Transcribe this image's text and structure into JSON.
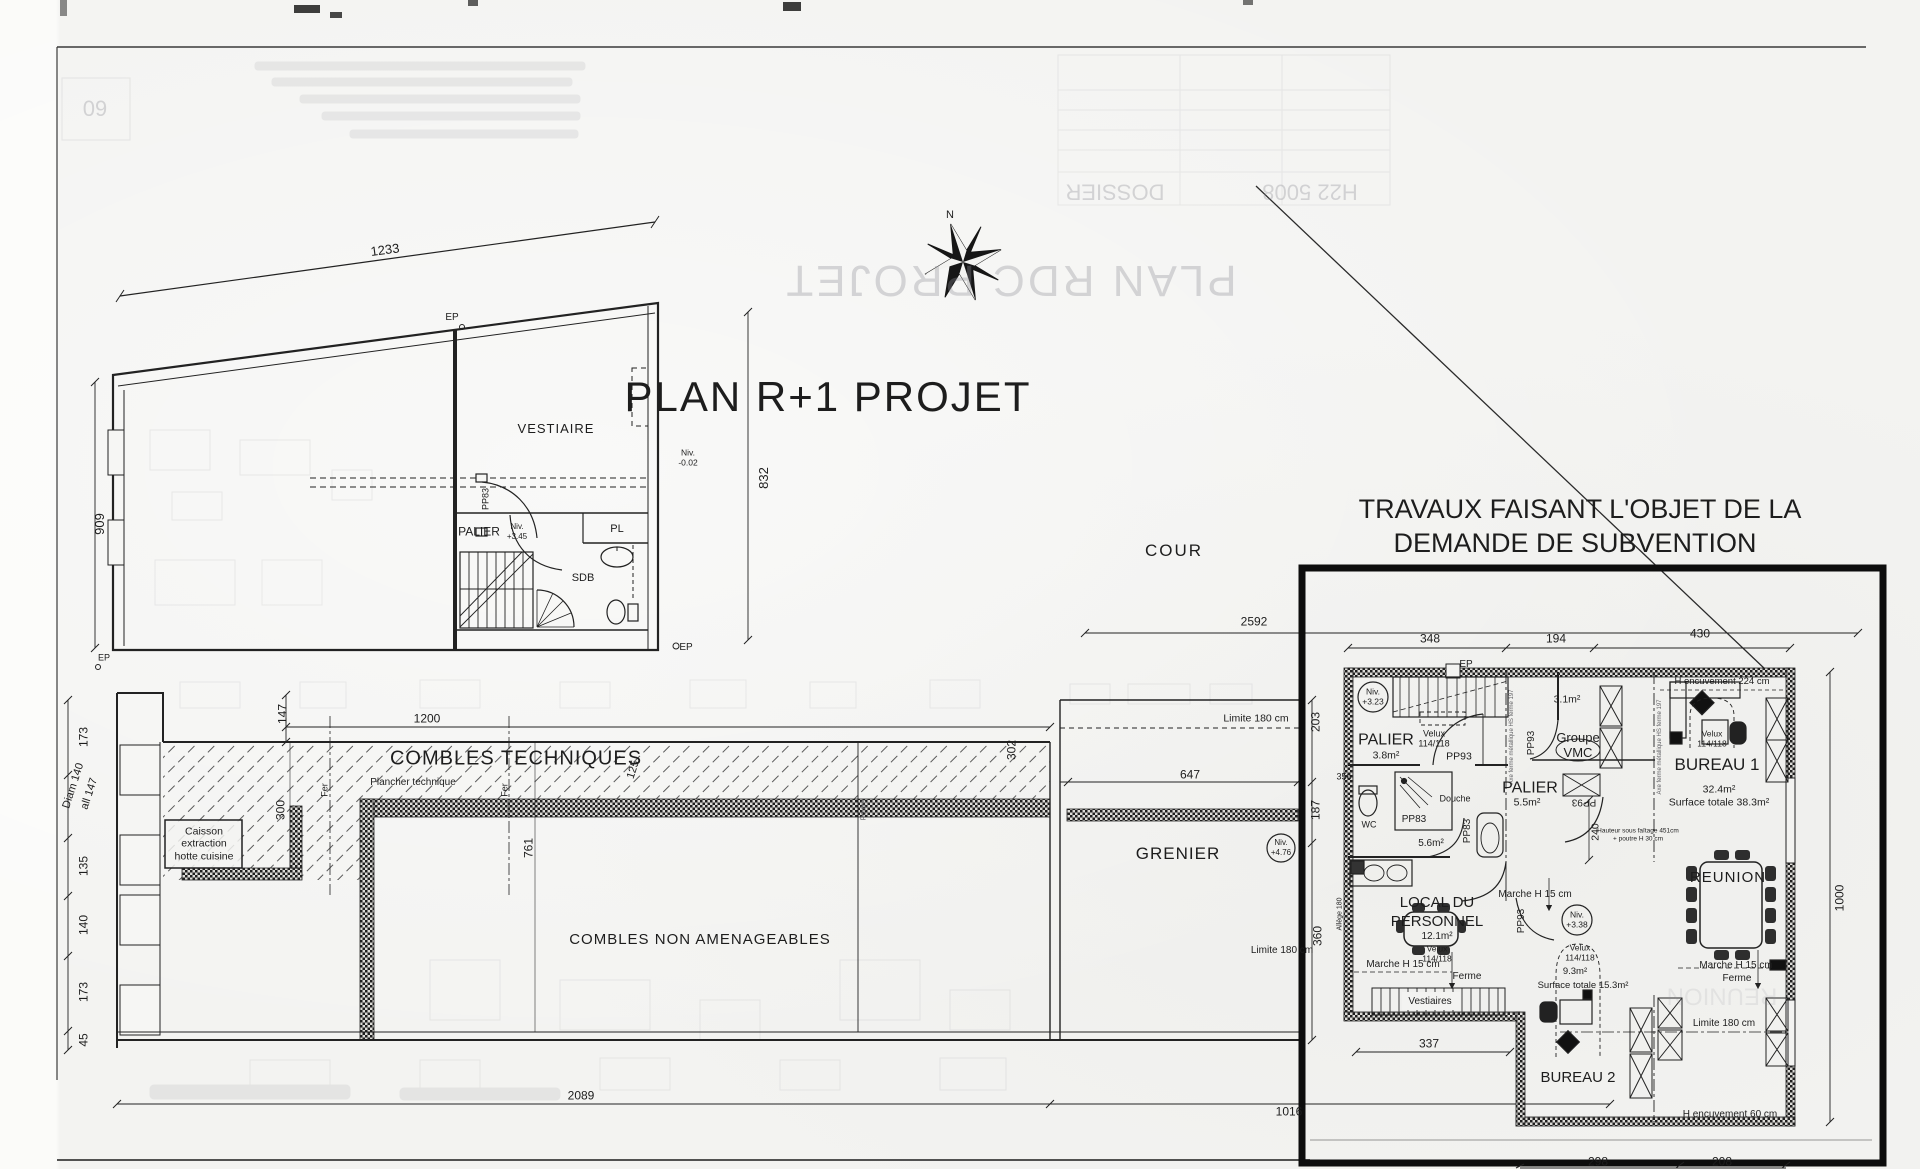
{
  "colors": {
    "ink": "#1d1d1d",
    "paper": "#f3f3f1",
    "bold_zone": "#0d0d0d",
    "bleed": "#8d8d95"
  },
  "sheet": {
    "main_title": "PLAN R+1 PROJET",
    "subvention_note_line1": "TRAVAUX FAISANT L'OBJET DE LA",
    "subvention_note_line2": "DEMANDE DE SUBVENTION",
    "courtyard_label": "COUR",
    "compass_north": "N",
    "bleedthrough": {
      "mirrored_title": "PLAN RDC PROJET",
      "sheet_number": "60",
      "titleblock_left": "DOSSIER",
      "titleblock_right": "H22 5008",
      "mirrored_room": "REUNION"
    }
  },
  "labels": [
    {
      "n": "dim-1233",
      "t": "1233",
      "x": 385,
      "y": 250,
      "s": 13,
      "r": -7.5
    },
    {
      "n": "ep-roof-label",
      "t": "EP",
      "x": 452,
      "y": 318,
      "s": 10
    },
    {
      "n": "dim-909",
      "t": "909",
      "x": 100,
      "y": 524,
      "s": 13,
      "r": -90
    },
    {
      "n": "room-vestiaire",
      "t": "VESTIAIRE",
      "x": 556,
      "y": 429,
      "s": 13,
      "ls": 1
    },
    {
      "n": "niv-minus002-l1",
      "t": "Niv.",
      "x": 688,
      "y": 453,
      "s": 8.5
    },
    {
      "n": "niv-minus002-l2",
      "t": "-0.02",
      "x": 688,
      "y": 463,
      "s": 8.5
    },
    {
      "n": "door-pp83-upper",
      "t": "PP83",
      "x": 486,
      "y": 499,
      "s": 9,
      "r": -90
    },
    {
      "n": "room-palier-upper",
      "t": "PALIER",
      "x": 479,
      "y": 532,
      "s": 12
    },
    {
      "n": "niv-345-l1",
      "t": "Niv.",
      "x": 517,
      "y": 527,
      "s": 8
    },
    {
      "n": "niv-345-l2",
      "t": "+3.45",
      "x": 517,
      "y": 537,
      "s": 8
    },
    {
      "n": "room-pl",
      "t": "PL",
      "x": 617,
      "y": 530,
      "s": 11
    },
    {
      "n": "room-sdb",
      "t": "SDB",
      "x": 583,
      "y": 579,
      "s": 11
    },
    {
      "n": "ep-bottom-label",
      "t": "EP",
      "x": 686,
      "y": 648,
      "s": 10
    },
    {
      "n": "dim-832",
      "t": "832",
      "x": 764,
      "y": 478,
      "s": 13,
      "r": -90
    },
    {
      "n": "ep-attic-label",
      "t": "EP",
      "x": 104,
      "y": 658,
      "s": 9
    },
    {
      "n": "dim-173a",
      "t": "173",
      "x": 84,
      "y": 737,
      "s": 12,
      "r": -90
    },
    {
      "n": "dim-diam140",
      "t": "Diam 140",
      "x": 74,
      "y": 786,
      "s": 11,
      "r": -72
    },
    {
      "n": "dim-all147",
      "t": "all 147",
      "x": 90,
      "y": 794,
      "s": 11,
      "r": -72
    },
    {
      "n": "dim-135",
      "t": "135",
      "x": 84,
      "y": 866,
      "s": 12,
      "r": -90
    },
    {
      "n": "dim-140",
      "t": "140",
      "x": 84,
      "y": 925,
      "s": 12,
      "r": -90
    },
    {
      "n": "dim-173b",
      "t": "173",
      "x": 84,
      "y": 992,
      "s": 12,
      "r": -90
    },
    {
      "n": "dim-45",
      "t": "45",
      "x": 84,
      "y": 1040,
      "s": 12,
      "r": -90
    },
    {
      "n": "dim-147",
      "t": "147",
      "x": 283,
      "y": 714,
      "s": 12,
      "r": -90
    },
    {
      "n": "dim-1200",
      "t": "1200",
      "x": 427,
      "y": 719,
      "s": 12
    },
    {
      "n": "room-combles-techniques",
      "t": "COMBLES TECHNIQUES",
      "x": 516,
      "y": 759,
      "s": 20,
      "ls": 1
    },
    {
      "n": "note-plancher-technique",
      "t": "Plancher technique",
      "x": 413,
      "y": 783,
      "s": 10
    },
    {
      "n": "axis-fer-1",
      "t": "Fer",
      "x": 325,
      "y": 790,
      "s": 9,
      "r": -90
    },
    {
      "n": "axis-fer-2",
      "t": "Fer",
      "x": 505,
      "y": 790,
      "s": 9,
      "r": -90
    },
    {
      "n": "dim-300",
      "t": "300",
      "x": 281,
      "y": 810,
      "s": 12,
      "r": -90
    },
    {
      "n": "dim-125",
      "t": "125",
      "x": 634,
      "y": 770,
      "s": 11,
      "r": -72
    },
    {
      "n": "dim-761",
      "t": "761",
      "x": 529,
      "y": 848,
      "s": 12,
      "r": -90
    },
    {
      "n": "caisson-l1",
      "t": "Caisson",
      "x": 204,
      "y": 832,
      "s": 10.5
    },
    {
      "n": "caisson-l2",
      "t": "extraction",
      "x": 204,
      "y": 844,
      "s": 10.5
    },
    {
      "n": "caisson-l3",
      "t": "hotte cuisine",
      "x": 204,
      "y": 857,
      "s": 10.5
    },
    {
      "n": "room-combles-non-amenageables",
      "t": "COMBLES NON AMENAGEABLES",
      "x": 700,
      "y": 940,
      "s": 15,
      "ls": 1
    },
    {
      "n": "dim-302",
      "t": "302",
      "x": 1012,
      "y": 750,
      "s": 12,
      "r": -90
    },
    {
      "n": "axis-poutre",
      "t": "Poutre",
      "x": 864,
      "y": 810,
      "s": 7,
      "r": -90,
      "c": "gray"
    },
    {
      "n": "room-grenier",
      "t": "GRENIER",
      "x": 1178,
      "y": 854,
      "s": 17,
      "ls": 1
    },
    {
      "n": "niv-476-l1",
      "t": "Niv.",
      "x": 1281,
      "y": 843,
      "s": 8
    },
    {
      "n": "niv-476-l2",
      "t": "+4.76",
      "x": 1281,
      "y": 853,
      "s": 8
    },
    {
      "n": "dim-647",
      "t": "647",
      "x": 1190,
      "y": 775,
      "s": 12
    },
    {
      "n": "limite-180-grenier-haut",
      "t": "Limite 180 cm",
      "x": 1256,
      "y": 719,
      "s": 10.5
    },
    {
      "n": "dim-203",
      "t": "203",
      "x": 1316,
      "y": 722,
      "s": 12,
      "r": -90
    },
    {
      "n": "dim-187",
      "t": "187",
      "x": 1316,
      "y": 810,
      "s": 12,
      "r": -90
    },
    {
      "n": "dim-356",
      "t": "356",
      "x": 1344,
      "y": 777,
      "s": 9
    },
    {
      "n": "dim-360",
      "t": "360",
      "x": 1318,
      "y": 936,
      "s": 12,
      "r": -90
    },
    {
      "n": "limite-180-grenier-bas",
      "t": "Limite 180 cm",
      "x": 1282,
      "y": 951,
      "s": 10
    },
    {
      "n": "dim-allege-180",
      "t": "Allège 180",
      "x": 1340,
      "y": 914,
      "s": 7,
      "r": -90
    },
    {
      "n": "dim-2592",
      "t": "2592",
      "x": 1254,
      "y": 622,
      "s": 12
    },
    {
      "n": "dim-2089",
      "t": "2089",
      "x": 581,
      "y": 1096,
      "s": 12
    },
    {
      "n": "dim-1016",
      "t": "1016",
      "x": 1289,
      "y": 1112,
      "s": 12
    },
    {
      "n": "dim-348",
      "t": "348",
      "x": 1430,
      "y": 639,
      "s": 12
    },
    {
      "n": "dim-194",
      "t": "194",
      "x": 1556,
      "y": 639,
      "s": 12
    },
    {
      "n": "dim-430",
      "t": "430",
      "x": 1700,
      "y": 634,
      "s": 12
    },
    {
      "n": "ep-zone-label",
      "t": "EP",
      "x": 1466,
      "y": 665,
      "s": 10
    },
    {
      "n": "niv-323-l1",
      "t": "Niv.",
      "x": 1373,
      "y": 692,
      "s": 8.5
    },
    {
      "n": "niv-323-l2",
      "t": "+3.23",
      "x": 1373,
      "y": 702,
      "s": 8.5
    },
    {
      "n": "room-palier-1",
      "t": "PALIER",
      "x": 1386,
      "y": 741,
      "s": 16
    },
    {
      "n": "palier-1-surface",
      "t": "3.8m²",
      "x": 1386,
      "y": 756,
      "s": 10.5
    },
    {
      "n": "velux-palier-l1",
      "t": "Velux",
      "x": 1434,
      "y": 734,
      "s": 9
    },
    {
      "n": "velux-palier-l2",
      "t": "114/118",
      "x": 1434,
      "y": 744,
      "s": 9
    },
    {
      "n": "door-pp93-palier",
      "t": "PP93",
      "x": 1459,
      "y": 757,
      "s": 10.5
    },
    {
      "n": "vmc-surface",
      "t": "3.1m²",
      "x": 1567,
      "y": 700,
      "s": 10.5
    },
    {
      "n": "groupe-vmc-l1",
      "t": "Groupe",
      "x": 1578,
      "y": 738,
      "s": 13
    },
    {
      "n": "groupe-vmc-l2",
      "t": "VMC",
      "x": 1578,
      "y": 753,
      "s": 13
    },
    {
      "n": "door-pp93-vmc",
      "t": "PP93",
      "x": 1532,
      "y": 743,
      "s": 10,
      "r": -90
    },
    {
      "n": "axis-ferme-1",
      "t": "Axe ferme métallique HS ferme 197",
      "x": 1512,
      "y": 737,
      "s": 6,
      "r": -90,
      "c": "gray"
    },
    {
      "n": "axis-ferme-2",
      "t": "Axe ferme métallique HS ferme 197",
      "x": 1660,
      "y": 747,
      "s": 6,
      "r": -90,
      "c": "gray"
    },
    {
      "n": "room-palier-2",
      "t": "PALIER",
      "x": 1530,
      "y": 789,
      "s": 16
    },
    {
      "n": "palier-2-surface",
      "t": "5.5m²",
      "x": 1527,
      "y": 803,
      "s": 10.5
    },
    {
      "n": "door-pp93-flip",
      "t": "PP93",
      "x": 1584,
      "y": 801,
      "s": 10,
      "r": 180
    },
    {
      "n": "dim-240",
      "t": "240",
      "x": 1596,
      "y": 832,
      "s": 10.5,
      "r": -90
    },
    {
      "n": "note-faitage-l1",
      "t": "Hauteur sous faîtage 451cm",
      "x": 1638,
      "y": 832,
      "s": 6.5
    },
    {
      "n": "note-faitage-l2",
      "t": "+ poutre H 30 cm",
      "x": 1638,
      "y": 840,
      "s": 6.5
    },
    {
      "n": "fixture-douche",
      "t": "Douche",
      "x": 1455,
      "y": 799,
      "s": 9
    },
    {
      "n": "fixture-wc",
      "t": "WC",
      "x": 1369,
      "y": 825,
      "s": 9
    },
    {
      "n": "door-pp83-a",
      "t": "PP83",
      "x": 1414,
      "y": 820,
      "s": 10
    },
    {
      "n": "door-pp83-b",
      "t": "PP83",
      "x": 1468,
      "y": 831,
      "s": 10,
      "r": -90
    },
    {
      "n": "sdb-surface",
      "t": "5.6m²",
      "x": 1431,
      "y": 844,
      "s": 10
    },
    {
      "n": "note-encuvement-224",
      "t": "H encuvement 224 cm",
      "x": 1722,
      "y": 682,
      "s": 9.5
    },
    {
      "n": "velux-b1-l1",
      "t": "Velux",
      "x": 1712,
      "y": 734,
      "s": 8.5
    },
    {
      "n": "velux-b1-l2",
      "t": "114/118",
      "x": 1712,
      "y": 744,
      "s": 8.5
    },
    {
      "n": "room-bureau-1",
      "t": "BUREAU 1",
      "x": 1717,
      "y": 765,
      "s": 17
    },
    {
      "n": "bureau-1-surface",
      "t": "32.4m²",
      "x": 1719,
      "y": 790,
      "s": 10.5
    },
    {
      "n": "bureau-1-surface-totale",
      "t": "Surface totale 38.3m²",
      "x": 1719,
      "y": 803,
      "s": 10.5
    },
    {
      "n": "room-reunion",
      "t": "REUNION",
      "x": 1728,
      "y": 878,
      "s": 15,
      "ls": 1
    },
    {
      "n": "dim-1000",
      "t": "1000",
      "x": 1840,
      "y": 898,
      "s": 12,
      "r": -90
    },
    {
      "n": "room-local-l1",
      "t": "LOCAL DU",
      "x": 1437,
      "y": 903,
      "s": 15
    },
    {
      "n": "room-local-l2",
      "t": "PERSONNEL",
      "x": 1437,
      "y": 922,
      "s": 15
    },
    {
      "n": "local-surface",
      "t": "12.1m²",
      "x": 1437,
      "y": 937,
      "s": 10
    },
    {
      "n": "velux-local-l1",
      "t": "Velux",
      "x": 1437,
      "y": 949,
      "s": 8.5
    },
    {
      "n": "velux-local-l2",
      "t": "114/118",
      "x": 1437,
      "y": 959,
      "s": 8.5
    },
    {
      "n": "marche-local",
      "t": "Marche H 15 cm",
      "x": 1403,
      "y": 965,
      "s": 10
    },
    {
      "n": "ferme-local",
      "t": "Ferme",
      "x": 1467,
      "y": 977,
      "s": 10
    },
    {
      "n": "closet-vestiaires",
      "t": "Vestiaires",
      "x": 1430,
      "y": 1002,
      "s": 10
    },
    {
      "n": "marche-palier2",
      "t": "Marche H 15 cm",
      "x": 1535,
      "y": 895,
      "s": 10
    },
    {
      "n": "door-pp93-bureau2",
      "t": "PP93",
      "x": 1522,
      "y": 921,
      "s": 10,
      "r": -90
    },
    {
      "n": "niv-338-l1",
      "t": "Niv.",
      "x": 1577,
      "y": 915,
      "s": 8.5
    },
    {
      "n": "niv-338-l2",
      "t": "+3.38",
      "x": 1577,
      "y": 925,
      "s": 8.5
    },
    {
      "n": "velux-b2-l1",
      "t": "Velux",
      "x": 1580,
      "y": 948,
      "s": 8.5
    },
    {
      "n": "velux-b2-l2",
      "t": "114/118",
      "x": 1580,
      "y": 958,
      "s": 8.5
    },
    {
      "n": "bureau-2-surface",
      "t": "9.3m²",
      "x": 1575,
      "y": 972,
      "s": 9.5
    },
    {
      "n": "bureau-2-surface-totale",
      "t": "Surface totale 15.3m²",
      "x": 1583,
      "y": 986,
      "s": 9.5
    },
    {
      "n": "marche-reunion",
      "t": "Marche H 15 cm",
      "x": 1736,
      "y": 966,
      "s": 10
    },
    {
      "n": "ferme-reunion",
      "t": "Ferme",
      "x": 1737,
      "y": 979,
      "s": 10
    },
    {
      "n": "limite-180-bureau2",
      "t": "Limite 180 cm",
      "x": 1724,
      "y": 1024,
      "s": 10
    },
    {
      "n": "room-bureau-2",
      "t": "BUREAU 2",
      "x": 1578,
      "y": 1078,
      "s": 15
    },
    {
      "n": "note-encuvement-60",
      "t": "H encuvement 60 cm",
      "x": 1730,
      "y": 1115,
      "s": 10
    },
    {
      "n": "dim-337",
      "t": "337",
      "x": 1429,
      "y": 1044,
      "s": 12
    },
    {
      "n": "dim-298",
      "t": "298",
      "x": 1598,
      "y": 1162,
      "s": 12
    },
    {
      "n": "dim-208",
      "t": "208",
      "x": 1722,
      "y": 1162,
      "s": 12
    }
  ]
}
